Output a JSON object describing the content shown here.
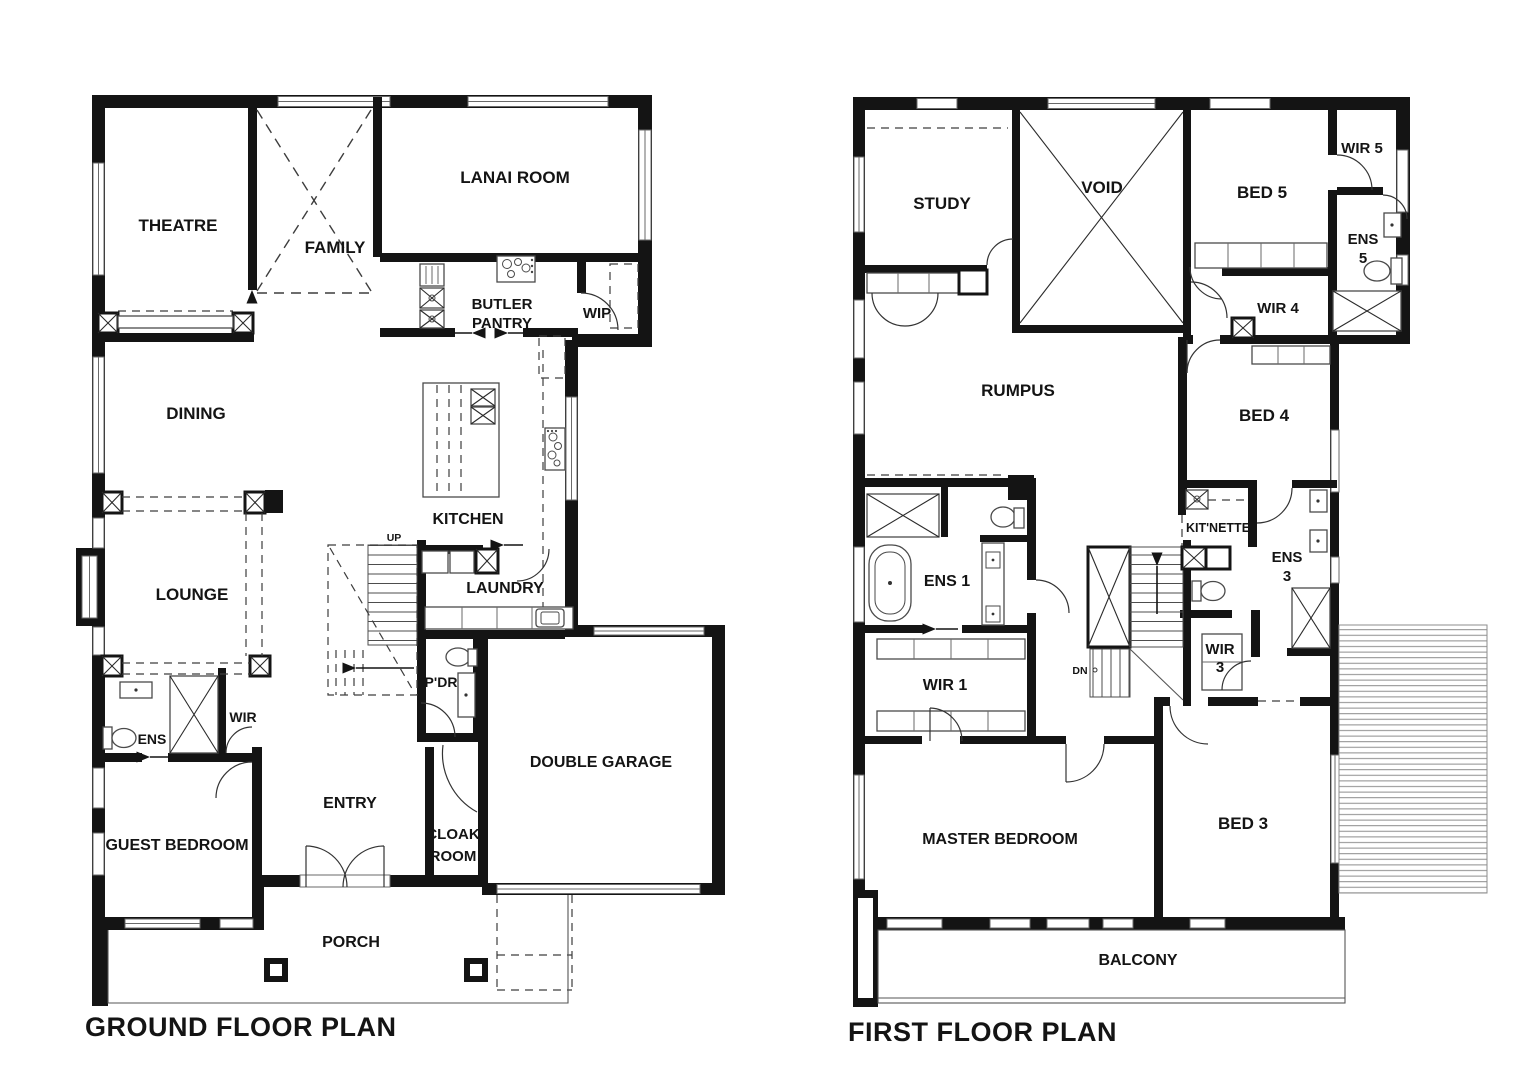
{
  "ground_floor": {
    "title": "GROUND FLOOR PLAN",
    "rooms": {
      "theatre": "THEATRE",
      "family": "FAMILY",
      "lanai_room": "LANAI ROOM",
      "butler_pantry": [
        "BUTLER",
        "PANTRY"
      ],
      "wip": "WIP",
      "dining": "DINING",
      "kitchen": "KITCHEN",
      "lounge": "LOUNGE",
      "laundry": "LAUNDRY",
      "powder": "P'DR",
      "ens": "ENS",
      "wir": "WIR",
      "guest_bedroom": "GUEST BEDROOM",
      "entry": "ENTRY",
      "cloak_room": [
        "CLOAK",
        "ROOM"
      ],
      "double_garage": "DOUBLE GARAGE",
      "porch": "PORCH"
    },
    "annotations": {
      "up": "UP"
    }
  },
  "first_floor": {
    "title": "FIRST FLOOR PLAN",
    "rooms": {
      "study": "STUDY",
      "void": "VOID",
      "bed5": "BED 5",
      "wir5": "WIR 5",
      "ens5": [
        "ENS",
        "5"
      ],
      "wir4": "WIR 4",
      "rumpus": "RUMPUS",
      "bed4": "BED 4",
      "ens1": "ENS 1",
      "kitnette": "KIT'NETTE",
      "ens3": [
        "ENS",
        "3"
      ],
      "wir3": [
        "WIR",
        "3"
      ],
      "wir1": "WIR 1",
      "master_bedroom": "MASTER BEDROOM",
      "bed3": "BED 3",
      "balcony": "BALCONY"
    },
    "annotations": {
      "dn": "DN"
    }
  },
  "colors": {
    "wall": "#141414",
    "thin_line": "#555555",
    "label": "#141414",
    "background": "#ffffff"
  }
}
